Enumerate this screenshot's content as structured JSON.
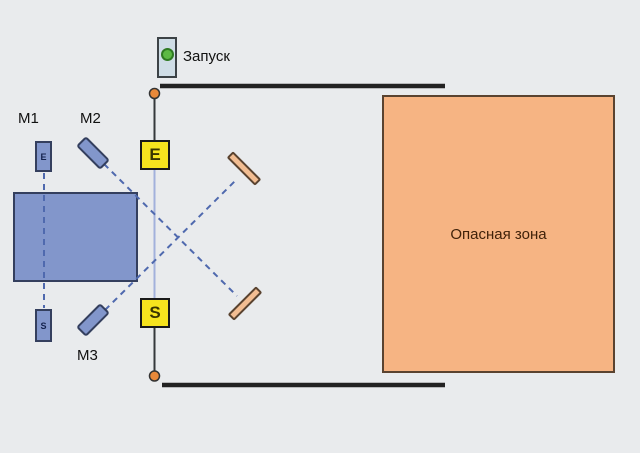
{
  "diagram_title": "safety-light-barrier-with-deflecting-mirrors",
  "start_button": {
    "label": "Запуск",
    "indicator_color": "#5cb944"
  },
  "labels": {
    "m1": "M1",
    "m2": "M2",
    "m3": "M3"
  },
  "emitter": {
    "label": "E"
  },
  "receiver": {
    "label": "S"
  },
  "m1_column": {
    "top_letter": "E",
    "bottom_letter": "S"
  },
  "danger_zone": {
    "label": "Опасная зона",
    "fill": "#f6b483"
  },
  "colors": {
    "background": "#e9ebed",
    "machine_blue": "#8296cb",
    "sensor_yellow": "#f7e41e",
    "danger_orange": "#f6b483",
    "mirror_orange": "#f2bd92",
    "beam_dashed_blue": "#4f69ae",
    "beam_active_blue": "#a2b1dc",
    "guard_line_black": "#222222",
    "junction_orange": "#e9893a"
  }
}
